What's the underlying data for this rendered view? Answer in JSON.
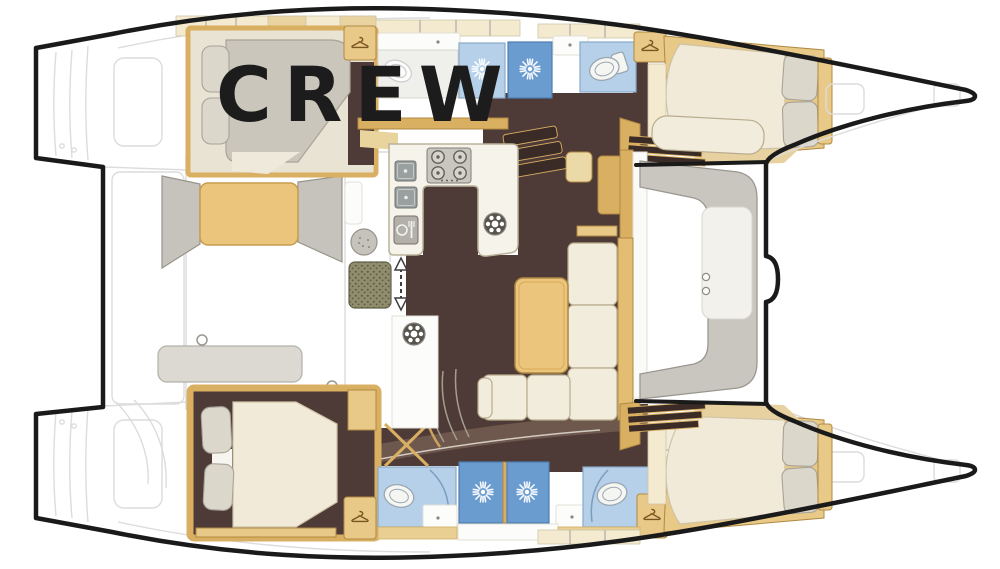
{
  "label": {
    "text": "CREW"
  },
  "colors": {
    "outline": "#1a1a1a",
    "text": "#1c1c1c",
    "white": "#ffffff",
    "lineFaint": "#dcdcdc",
    "lineMid": "#b9b5aa",
    "floorDark": "#4e3b37",
    "floorMid": "#6e574c",
    "wood": "#d9af62",
    "woodDark": "#b08942",
    "woodMid": "#e8c987",
    "woodPale": "#f4ead0",
    "woodSeg": "#e9d3a0",
    "cabEdge": "#cfc5a9",
    "cream": "#f2ecdd",
    "creamEdge": "#b9ab8d",
    "mattress": "#f1ead8",
    "mattressEdge": "#cfc3a6",
    "bedGray": "#cbc6bc",
    "pillowGray": "#dcd7cb",
    "pillowEdge": "#a8a399",
    "blueLight": "#b5d0e8",
    "blueLightEdge": "#8aaac8",
    "blueMid": "#6b9ccf",
    "blueMidEdge": "#4c7cb0",
    "fixtureGray": "#c6c3bc",
    "fixtureEdge": "#97948c",
    "matOlive": "#8f8d6d",
    "matDot": "#5c5a41",
    "stairDark": "#3a2b27"
  },
  "icons": {
    "shower_head": "sun-burst",
    "wardrobe": "coat-hanger",
    "galley": [
      "stove-4-burner",
      "double-sink",
      "fridge",
      "fan-vent"
    ],
    "companionway": "double-arrow",
    "fixtures": [
      "toilet",
      "washbasin",
      "washer"
    ]
  }
}
